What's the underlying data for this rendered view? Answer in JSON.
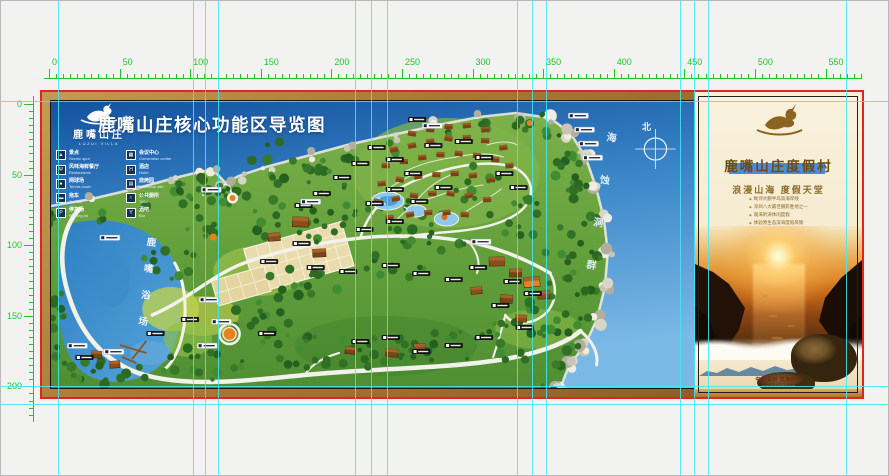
{
  "rulers": {
    "horizontal_labels": [
      "0",
      "50",
      "100",
      "150",
      "200",
      "250",
      "300",
      "350",
      "400",
      "450",
      "500",
      "550"
    ],
    "vertical_labels": [
      "0",
      "50",
      "100",
      "150",
      "200"
    ],
    "color": "#1fc32b"
  },
  "guides": {
    "color": "#42e7f4",
    "vertical_x": [
      57,
      192,
      204,
      217,
      354,
      370,
      386,
      516,
      531,
      545,
      679,
      693,
      707,
      845
    ],
    "horizontal_y": [
      100,
      385,
      403
    ]
  },
  "poster": {
    "page_border_color": "#e3241c",
    "map": {
      "logo_cn": "鹿嘴山庄",
      "logo_en": "LUZUI VILLA",
      "title": "鹿嘴山庄核心功能区导览图",
      "legend": [
        {
          "icon": "▲",
          "cn": "景点",
          "en": "Scenic spot"
        },
        {
          "icon": "Ψ",
          "cn": "风味海鲜餐厅",
          "en": "Restaurants"
        },
        {
          "icon": "●",
          "cn": "网球场",
          "en": "Tennis court"
        },
        {
          "icon": "▬",
          "cn": "拖车",
          "en": "Towbar"
        },
        {
          "icon": "P",
          "cn": "停车场",
          "en": "Parking lot"
        },
        {
          "icon": "▦",
          "cn": "会议中心",
          "en": "Convention center"
        },
        {
          "icon": "H",
          "cn": "酒店",
          "en": "Hotel"
        },
        {
          "icon": "▤",
          "cn": "烧烤园",
          "en": "Barbecue site"
        },
        {
          "icon": "♀",
          "cn": "公共厕所",
          "en": "Toilet"
        },
        {
          "icon": "Y",
          "cn": "酒吧",
          "en": "Bar"
        }
      ],
      "beach_label": "鹿嘴浴场",
      "sea_caves_label": "海蚀洞群",
      "compass_north": "北"
    },
    "panel": {
      "resort_title": "鹿嘴山庄度假村",
      "slogan": "浪漫山海  度假天堂",
      "bullets": [
        "毗邻大鹏半岛滨海岸线",
        "深圳八大最佳摄影胜地之一",
        "观海听涛休闲度假",
        "体验原生态滨海度假风情"
      ],
      "footer_location": "中国深圳·滨海度假",
      "footer_url": "www.luzuivilla.com",
      "accent_bar_color": "#4e8ad8"
    }
  }
}
